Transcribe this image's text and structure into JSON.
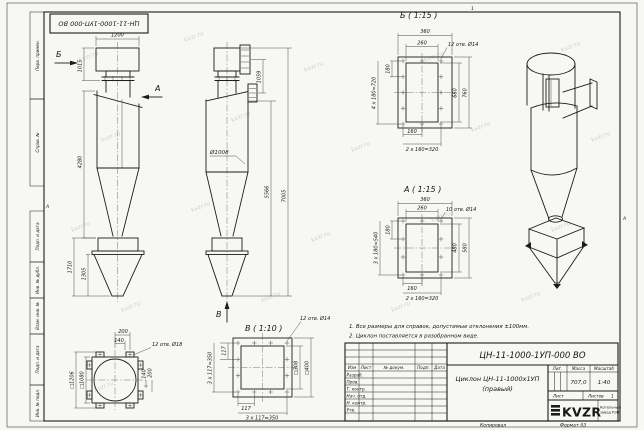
{
  "stamp": "ЦН-11-1000-1УП-000 ВО",
  "margin_labels": [
    "Перв. примен.",
    "Справ. №",
    "Подп. и дата",
    "Инв. № дубл.",
    "Взам. инв. №",
    "Подп. и дата",
    "Инв. № подл."
  ],
  "zones": {
    "top": "1",
    "side": "А"
  },
  "watermark": "kvzr.ru",
  "notes": [
    "1. Все размеры для справок, допустимые отклонения ±100мм.",
    "2. Циклон поставляется в разобранном виде."
  ],
  "views": {
    "front": {
      "arrow_b": "Б",
      "arrow_a": "А",
      "dims": {
        "w_top": "1200",
        "h_top": "1015",
        "h_body": "4280",
        "h_bunker": "1710",
        "h_cone": "1305"
      }
    },
    "side": {
      "arrow_v": "В",
      "dims": {
        "h_flanges": "1059",
        "d_body": "Ø1008",
        "h_mid": "5566",
        "h_total": "7005"
      }
    },
    "detail_b": {
      "label": "Б ( 1:15 )",
      "dims": {
        "w_out": "360",
        "w_in": "260",
        "holes": "12 отв. Ø14",
        "pitch": "180",
        "pitch_v": "4 х 180=720",
        "h_in": "660",
        "h_out": "760",
        "pitch_b": "160",
        "pitch_h": "2 х 160=320"
      }
    },
    "detail_a": {
      "label": "А ( 1:15 )",
      "dims": {
        "w_out": "360",
        "w_in": "260",
        "holes": "10 отв. Ø14",
        "pitch": "180",
        "pitch_v": "3 х 180=540",
        "h_in": "480",
        "h_out": "580",
        "pitch_b": "160",
        "pitch_h": "2 х 160=320"
      }
    },
    "flange": {
      "dims": {
        "off1": "200",
        "off2": "140",
        "holes": "12 отв. Ø18",
        "sq_out": "□1206",
        "sq_in": "□1080",
        "off_r1": "140",
        "off_r2": "200"
      }
    },
    "detail_v": {
      "label": "В ( 1:10 )",
      "dims": {
        "holes": "12 отв. Ø14",
        "v117": "117",
        "v350": "3 х 117=350",
        "h117": "117",
        "h350": "3 х 117=350",
        "sq_in": "□308",
        "sq_out": "□400"
      }
    }
  },
  "title_block": {
    "doc_number": "ЦН-11-1000-1УП-000 ВО",
    "name_line1": "Циклон ЦН-11-1000х1УП",
    "name_line2": "(правый)",
    "cols": {
      "izm": "Изм",
      "list": "Лист",
      "doc": "№ докум.",
      "sign": "Подп.",
      "date": "Дата"
    },
    "rows": [
      "Разраб.",
      "Пров.",
      "Т. контр.",
      "Нач. отд.",
      "Н. контр.",
      "Утв."
    ],
    "lit_label": "Лит.",
    "mass_label": "Масса",
    "scale_label": "Масштаб",
    "mass": "707,0",
    "scale": "1:40",
    "sheet_label": "Лист",
    "sheets_label": "Листов",
    "sheets_value": "1",
    "logo": "KVZR",
    "company_line1": "Котельный",
    "company_line2": "завод РЭП"
  },
  "footer": {
    "copied": "Копировал",
    "format": "Формат А3"
  }
}
